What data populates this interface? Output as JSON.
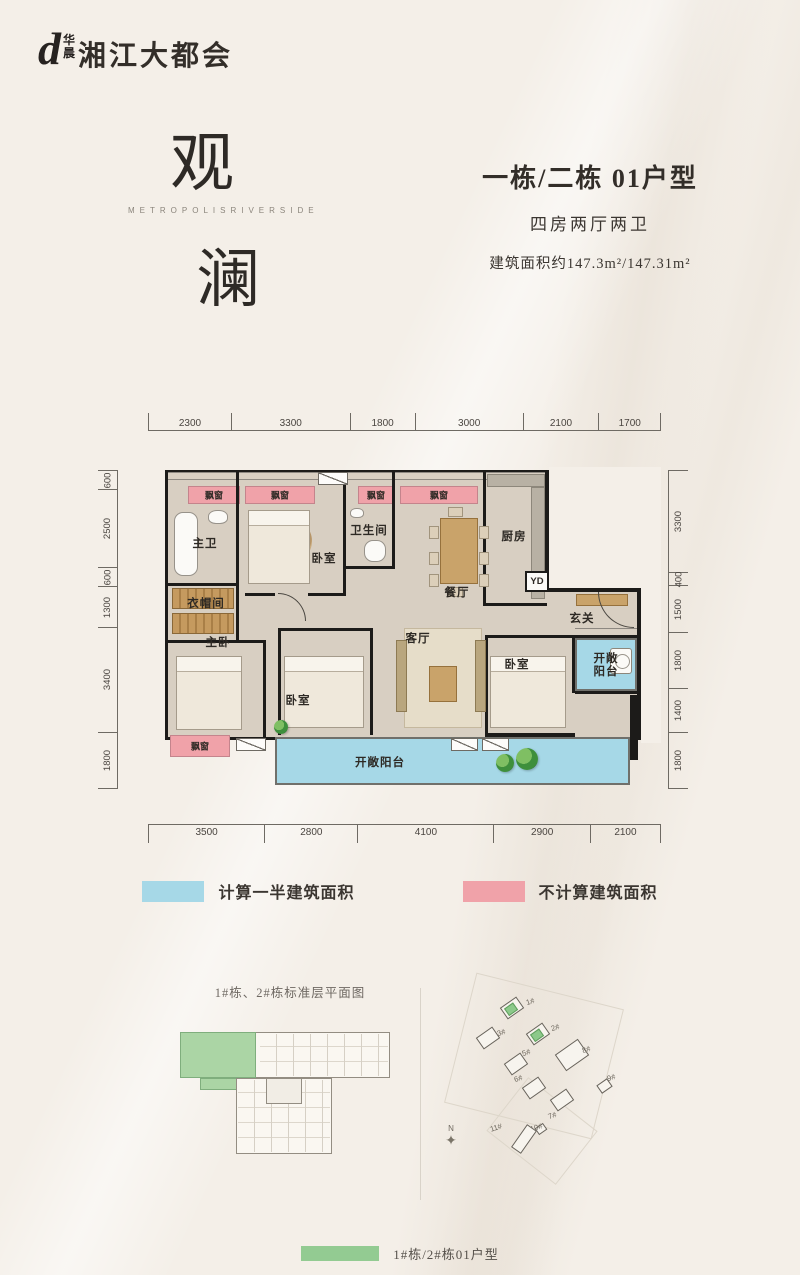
{
  "colors": {
    "blue": "#a6d8e7",
    "pink": "#f0a2a9",
    "green": "#93cb92",
    "keygreen": "#abd5a5"
  },
  "header": {
    "logo_mark": "d",
    "logo_top": "华",
    "logo_bottom": "晨",
    "logo_name": "湘江大都会"
  },
  "hero": {
    "char_top": "观",
    "english": "METROPOLISRIVERSIDE",
    "char_bottom": "澜"
  },
  "unit": {
    "title": "一栋/二栋 01户型",
    "rooms": "四房两厅两卫",
    "area": "建筑面积约147.3m²/147.31m²"
  },
  "plan": {
    "labels": {
      "bay_window": "飘窗",
      "master_bath": "主卫",
      "bedroom": "卧室",
      "bathroom": "卫生间",
      "dining": "餐厅",
      "kitchen": "厨房",
      "laundry": "YD",
      "foyer": "玄关",
      "cloakroom": "衣帽间",
      "master_bedroom": "主卧",
      "living": "客厅",
      "open_balcony": "开敞阳台"
    },
    "dims": {
      "top": [
        2300,
        3300,
        1800,
        3000,
        2100,
        1700
      ],
      "bottom": [
        3500,
        2800,
        4100,
        2900,
        2100
      ],
      "left": [
        600,
        2500,
        600,
        1300,
        3400,
        1800
      ],
      "right": [
        3300,
        400,
        1500,
        1800,
        1400,
        1800
      ]
    }
  },
  "legend": {
    "half": "计算一半建筑面积",
    "excluded": "不计算建筑面积"
  },
  "bottom": {
    "key_caption": "1#栋、2#栋标准层平面图",
    "site_buildings": [
      {
        "label": "1#",
        "bx": 62,
        "by": 16,
        "lx": 86,
        "ly": 12,
        "green": true
      },
      {
        "label": "2#",
        "bx": 88,
        "by": 42,
        "lx": 111,
        "ly": 38,
        "green": true
      },
      {
        "label": "3#",
        "bx": 38,
        "by": 46,
        "lx": 57,
        "ly": 43
      },
      {
        "label": "5#",
        "bx": 66,
        "by": 72,
        "lx": 82,
        "ly": 63
      },
      {
        "label": "8#",
        "bx": 118,
        "by": 60,
        "lx": 142,
        "ly": 60,
        "w": 28,
        "h": 20
      },
      {
        "label": "9#",
        "bx": 158,
        "by": 96,
        "lx": 167,
        "ly": 88,
        "w": 13,
        "h": 10
      },
      {
        "label": "6#",
        "bx": 84,
        "by": 96,
        "lx": 74,
        "ly": 89
      },
      {
        "label": "7#",
        "bx": 112,
        "by": 108,
        "lx": 108,
        "ly": 126
      },
      {
        "label": "10#",
        "bx": 96,
        "by": 140,
        "lx": 90,
        "ly": 138,
        "w": 10,
        "h": 8
      },
      {
        "label": "11#",
        "bx": 70,
        "by": 148,
        "lx": 50,
        "ly": 138,
        "w": 28,
        "h": 12,
        "rot": -55
      }
    ],
    "compass_n": "N",
    "unit_legend": "1#栋/2#栋01户型"
  },
  "icons": {
    "compass": "✦"
  }
}
